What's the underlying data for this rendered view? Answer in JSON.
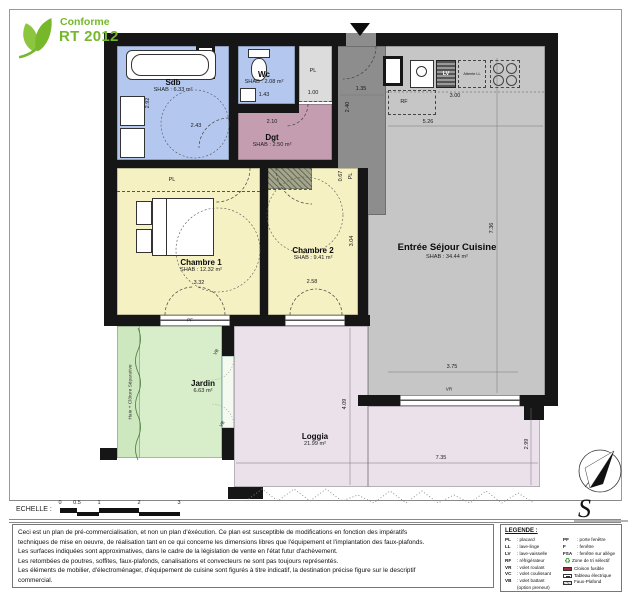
{
  "logo": {
    "line1": "Conforme",
    "line2": "RT 2012"
  },
  "plan": {
    "rooms": {
      "sdb": {
        "name": "Sdb",
        "area": "SHAB : 6.33 m²"
      },
      "wc": {
        "name": "Wc",
        "area": "SHAB : 2.08 m²"
      },
      "dgt": {
        "name": "Dgt",
        "area": "SHAB : 2.50 m²"
      },
      "chambre1": {
        "name": "Chambre 1",
        "area": "SHAB : 12.32 m²"
      },
      "chambre2": {
        "name": "Chambre 2",
        "area": "SHAB : 9.41 m²"
      },
      "sejour": {
        "name": "Entrée Séjour Cuisine",
        "area": "SHAB : 34.44 m²"
      },
      "jardin": {
        "name": "Jardin",
        "area": "6.63 m²"
      },
      "loggia": {
        "name": "Loggia",
        "area": "21.99 m²"
      }
    },
    "fixtures": {
      "pl": "PL",
      "rf": "RF",
      "lv": "LV",
      "vb": "VB",
      "pf": "PF",
      "vr": "VR",
      "attente_ll": "Attente LL"
    },
    "annotations": {
      "haie": "Haie + Clôture Séparative"
    },
    "dims": {
      "sdb_w": "2.43",
      "sdb_h": "2.92",
      "wc_w": "1.43",
      "pl_w": "1.00",
      "entry_w": "1.35",
      "entry_h": "2.40",
      "dgt_w": "2.10",
      "kitchen_w": "3.00",
      "sejour_top": "5.26",
      "sejour_h": "7.36",
      "sejour_bottom": "3.75",
      "c1_w": "3.32",
      "c2_w": "2.58",
      "c2_h": "3.04",
      "c2_pl": "0.67",
      "loggia_h": "4.09",
      "loggia_w": "7.35",
      "loggia_r": "2.99"
    }
  },
  "scalebar": {
    "label": "ECHELLE :",
    "ticks": [
      "0",
      "0.5",
      "1",
      "2",
      "3"
    ]
  },
  "disclaimer": {
    "lines": [
      "Ceci est un plan de pré-commercialisation, et non un plan d'éxécution. Ce plan est susceptible de modifications en fonction des impératifs",
      "techniques de mise en oeuvre, de réalisation tant en ce qui concerne les dimensions libres que l'équipement et l'implantation des faux-plafonds.",
      "Les surfaces indiquées sont approximatives, dans le cadre de la législation de vente en l'état futur d'achèvement.",
      "Les retombées de poutres, soffites, faux-plafonds, canalisations et convecteurs ne sont pas toujours représentés.",
      "Les éléments de mobilier, d'électroménager, d'équipement de cuisine sont figurés à titre indicatif, la destination précise figure sur le descriptif",
      "commercial."
    ]
  },
  "legend": {
    "title": "LEGENDE :",
    "left": [
      {
        "abbr": "PL",
        "label": ": placard"
      },
      {
        "abbr": "LL",
        "label": ": lave-linge"
      },
      {
        "abbr": "LV",
        "label": ": lave-vaisselle"
      },
      {
        "abbr": "RF",
        "label": ": réfrigérateur"
      },
      {
        "abbr": "VR",
        "label": ": volet roulant"
      },
      {
        "abbr": "VC",
        "label": ": volet coulissant"
      },
      {
        "abbr": "VB",
        "label": ": volet battant"
      },
      {
        "abbr": "",
        "label": "(option preneur)"
      }
    ],
    "right": [
      {
        "abbr": "PF",
        "label": ": porte fenêtre"
      },
      {
        "abbr": "F",
        "label": ": fenêtre"
      },
      {
        "abbr": "FSA",
        "label": ": fenêtre sur allège"
      }
    ],
    "symbols": [
      {
        "icon": "recycle-icon",
        "label": "Zone de tri sélectif"
      },
      {
        "icon": "fusible-swatch",
        "label": "Cloison fusible"
      },
      {
        "icon": "electrical-panel-swatch",
        "label": "Tableau électrique"
      },
      {
        "icon": "faux-plafond-swatch",
        "label": "Faux-Plafond"
      }
    ]
  },
  "compass": {
    "label": "S"
  }
}
